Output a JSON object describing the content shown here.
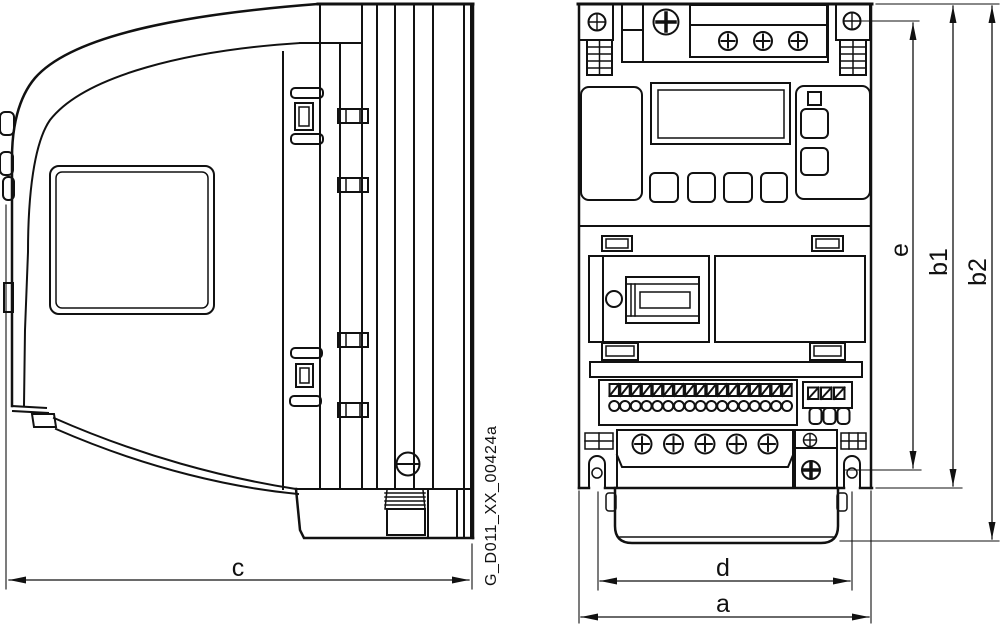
{
  "drawing": {
    "background": "#ffffff",
    "line_color": "#111111",
    "part_number": "G_D011_XX_00424a",
    "labels": {
      "a": "a",
      "b1": "b1",
      "b2": "b2",
      "c": "c",
      "d": "d",
      "e": "e"
    },
    "counts": {
      "io_terminals": 17,
      "relay_terminals": 3,
      "power_screws": 5,
      "line_screws": 3
    }
  }
}
